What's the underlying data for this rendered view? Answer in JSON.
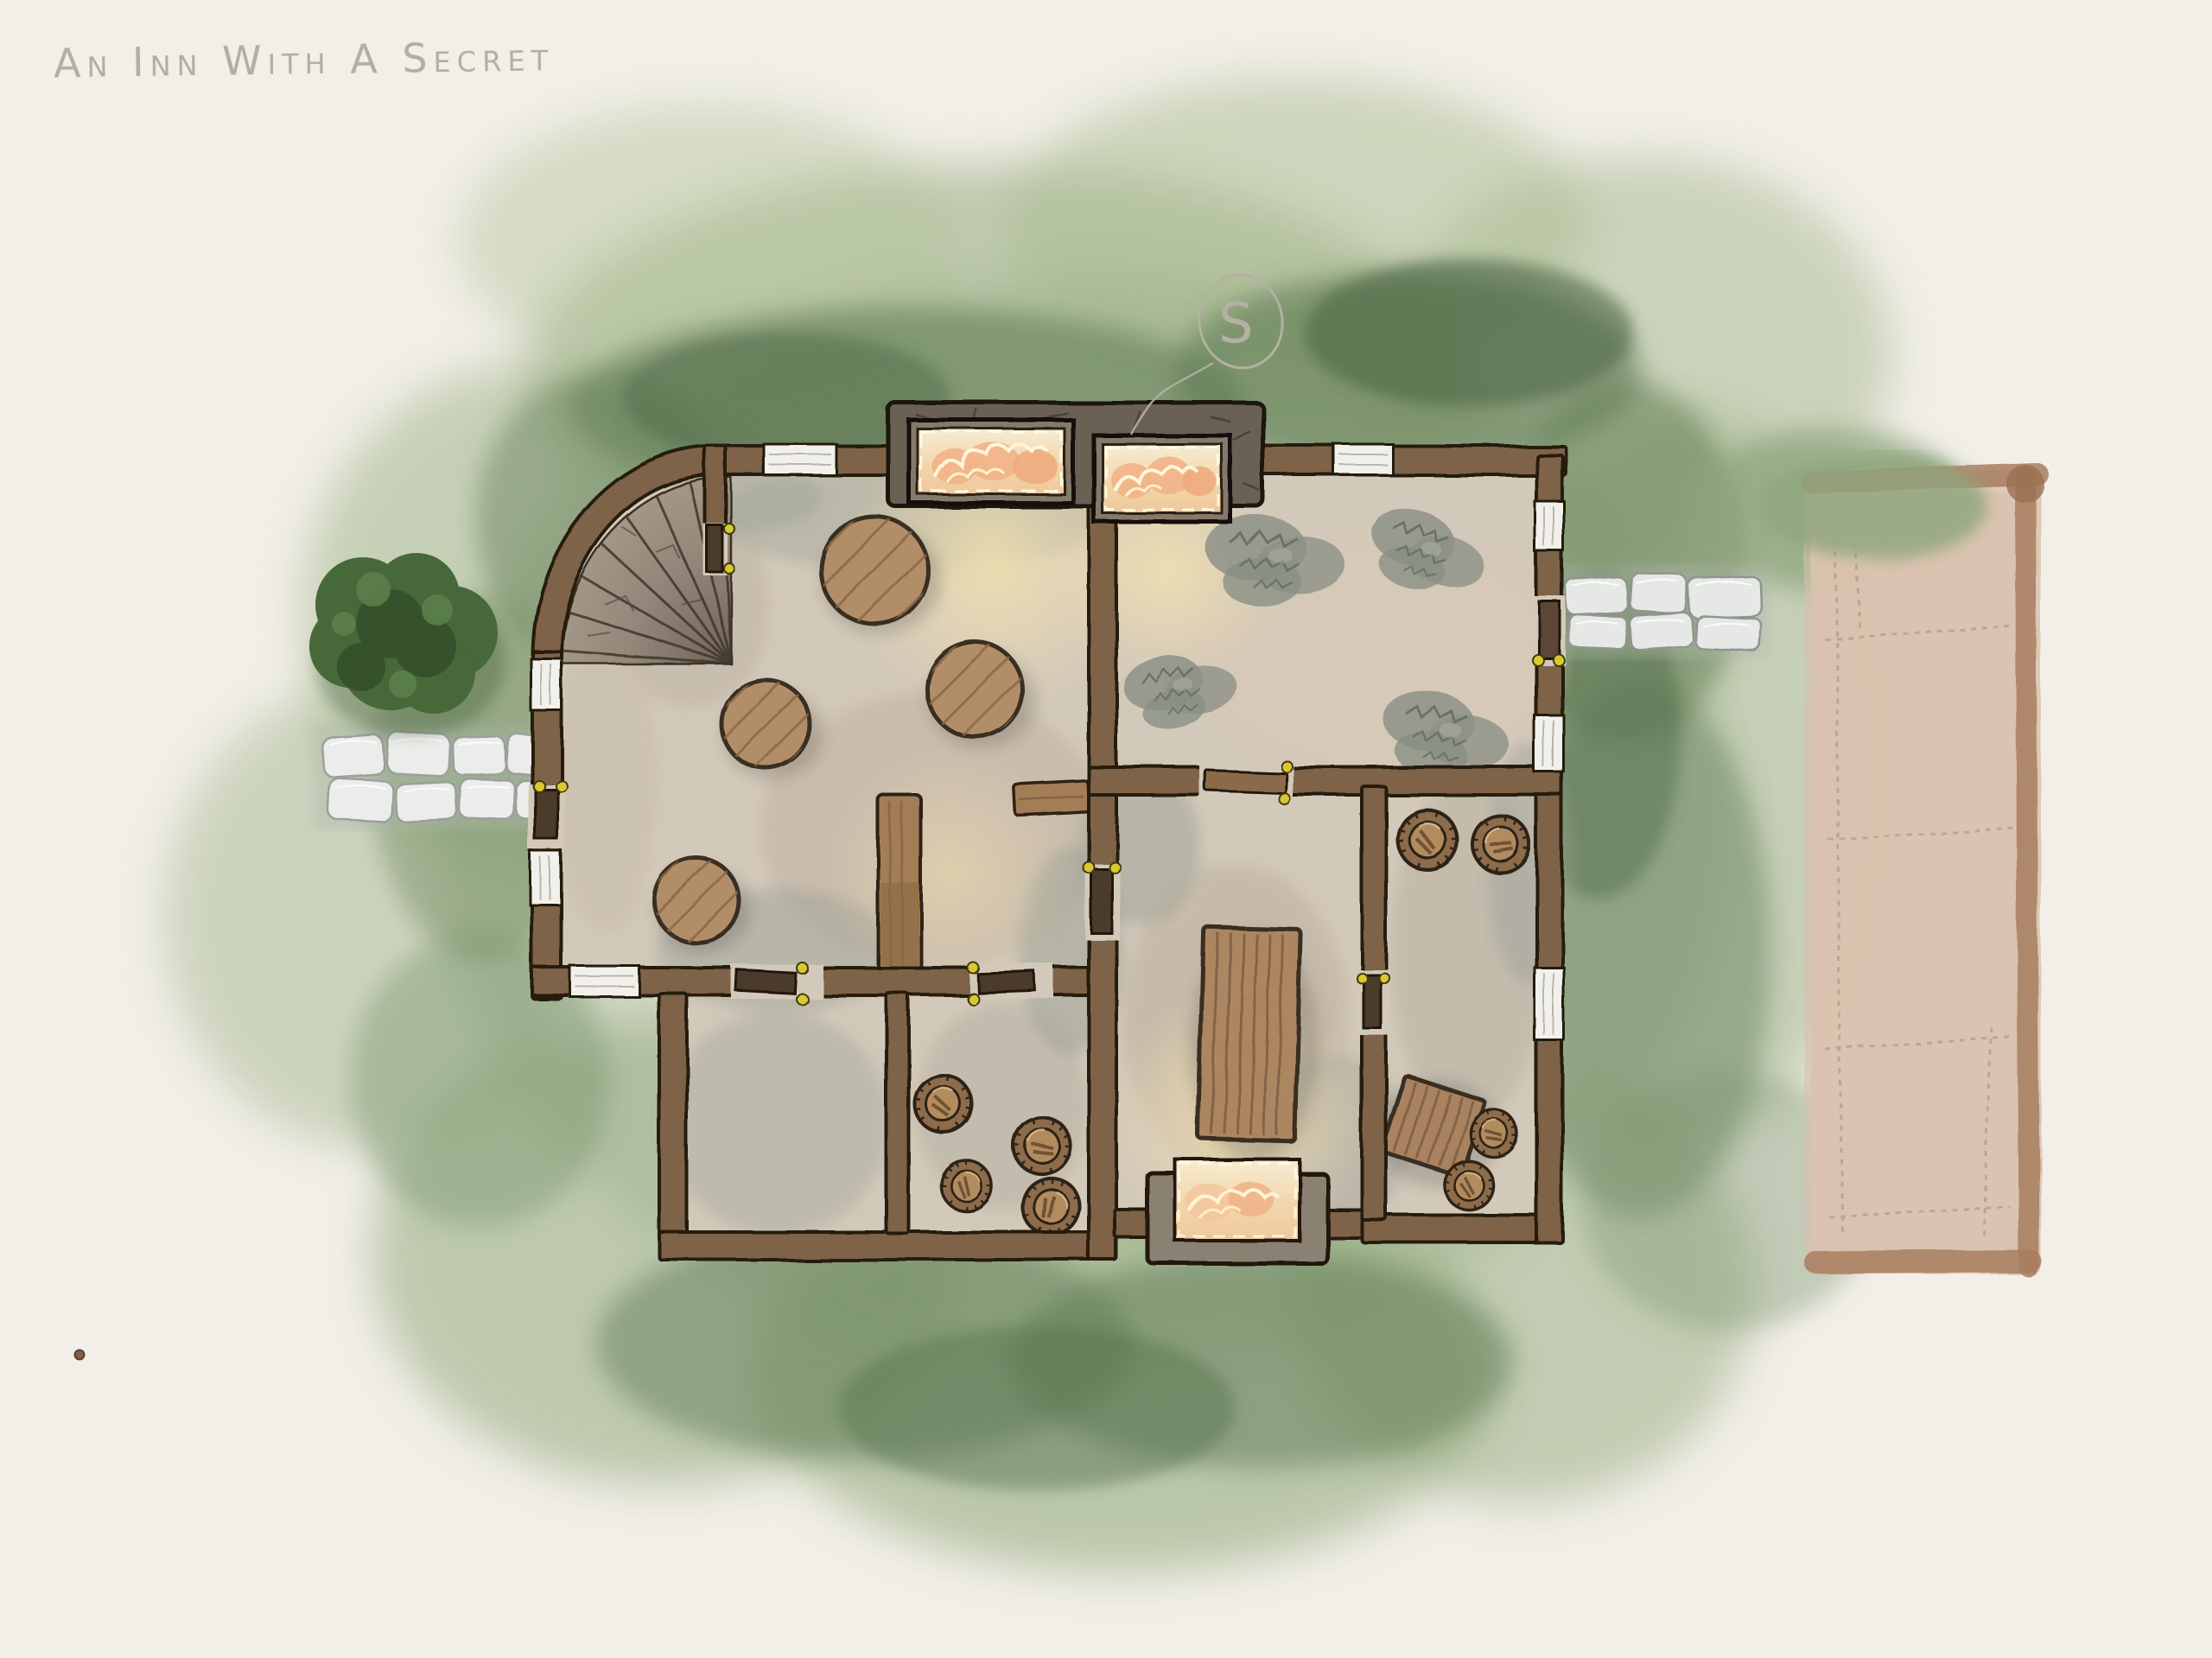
{
  "title": "An Inn With A Secret",
  "secret_marker": {
    "letter": "S",
    "style": "faint-pencil-circle-above-building"
  },
  "palette": {
    "paper": "#f2efe8",
    "grass_light": "#aabc92",
    "grass_mid": "#8fa57c",
    "grass_dark": "#5d7952",
    "wall_brown": "#7e644a",
    "wall_outline": "#261c11",
    "floor": "#d3c9ba",
    "wood": "#b28e68",
    "wood_dark": "#7d5e41",
    "stone_stairs": "#8d8173",
    "fireplace_stone": "#6b6052",
    "fire_glow": "#f6e7c4",
    "fire_flame": "#f2b387",
    "hinge_yellow": "#d9c832",
    "path_stone": "#ecedeb",
    "annex_tan": "#dcc6b4",
    "annex_border": "#a87d5e",
    "pencil": "#b4b0a3",
    "scribble_gray": "#8d9187",
    "bush_green": "#476839",
    "red_dot": "#80614c"
  },
  "features": {
    "building": {
      "rooms": [
        {
          "name": "tavern-hall",
          "contents": "4 round tables, bar counter, wall counter, curved stone staircase"
        },
        {
          "name": "north-east-room",
          "contents": "4 gray scribble floor patches, fireplace"
        },
        {
          "name": "central-room",
          "contents": "long plank table, south fireplace"
        },
        {
          "name": "east-storage-room",
          "contents": "4 barrels, tilted square table"
        },
        {
          "name": "south-west-room",
          "contents": "empty"
        },
        {
          "name": "south-storage-room",
          "contents": "4 barrels"
        }
      ],
      "fireplaces": 3,
      "doors": 8,
      "windows": 8
    },
    "grounds": "bush west of inn, cobblestone path west, cobblestone path east, penciled tan annex east, small red dot lower-left"
  }
}
